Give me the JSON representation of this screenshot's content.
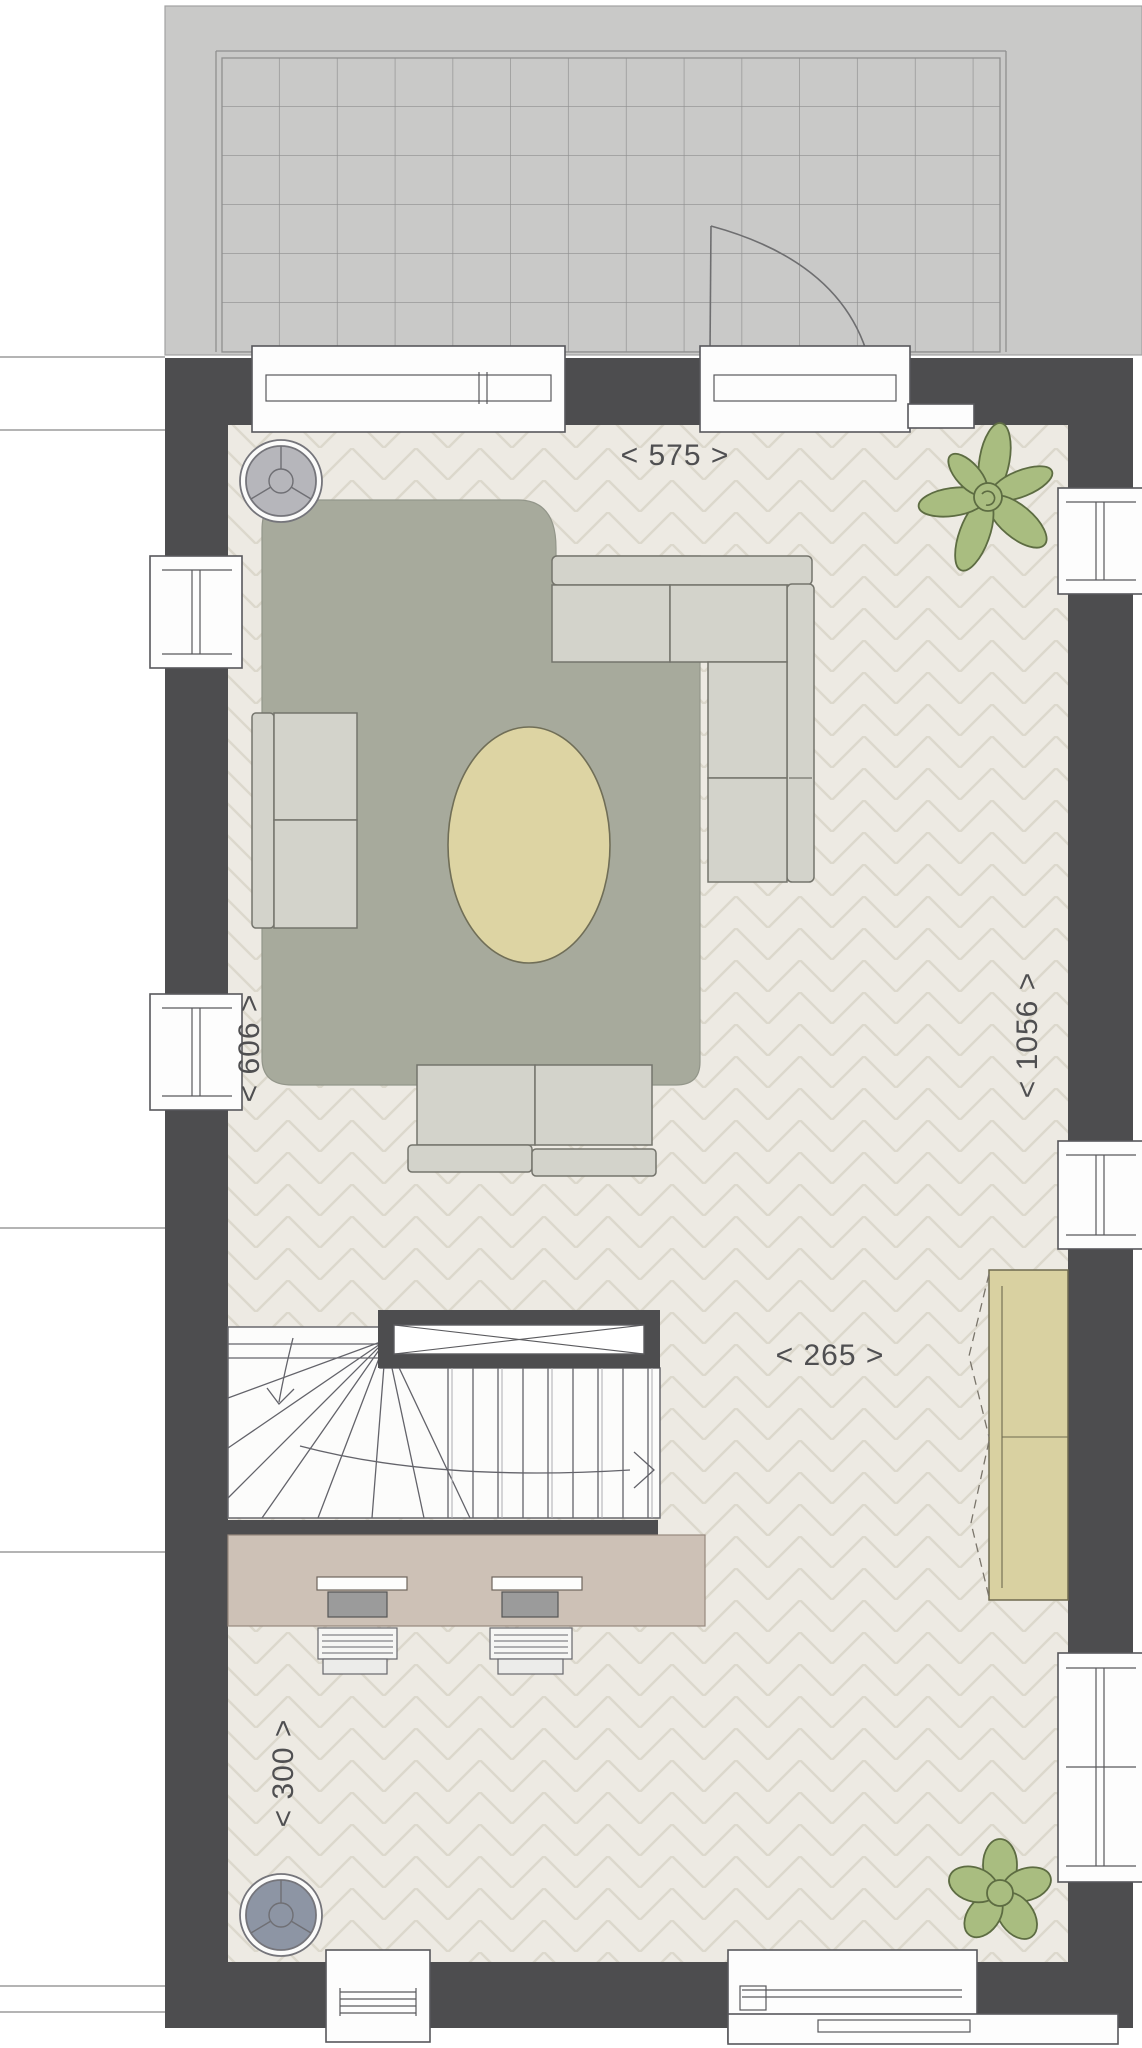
{
  "plan": {
    "type": "floor-plan-top-view",
    "dimensions": {
      "terrace_width": "< 575 >",
      "left_wall": "< 606 >",
      "right_wall": "< 1056 >",
      "stair_area": "< 265 >",
      "bottom_area": "< 300 >"
    },
    "colors": {
      "wall": "#4d4d4f",
      "terrace": "#c9c9c8",
      "tile_line": "#8f8f8f",
      "floor": "#edeae3",
      "floor_line": "#dcd8cc",
      "rug": "#a7aa9c",
      "sofa": "#d3d3cb",
      "sofa_outline": "#74746c",
      "oval": "#ddd4a3",
      "desk": "#cdc1b6",
      "monitor": "#9b9b9b",
      "cabinet": "#d9d1a1",
      "plant": "#a9bd80",
      "plant_outline": "#5d6c42",
      "chair_top": "#b6b6bb",
      "chair_bottom": "#8d95a4",
      "window_outline": "#58585c",
      "text": "#4f4f51"
    },
    "elements": [
      "tiled-terrace",
      "terrace-door-swing",
      "living-room-herringbone-floor",
      "corner-sectional-sofa",
      "two-seat-sofa",
      "armchair",
      "area-rug",
      "oval-coffee-table",
      "winder-staircase",
      "stair-railing",
      "desk-with-two-workstations",
      "two-desk-chairs",
      "tall-cabinet",
      "round-side-chair-top",
      "round-side-chair-bottom",
      "plant-top-right",
      "plant-bottom-right"
    ]
  }
}
